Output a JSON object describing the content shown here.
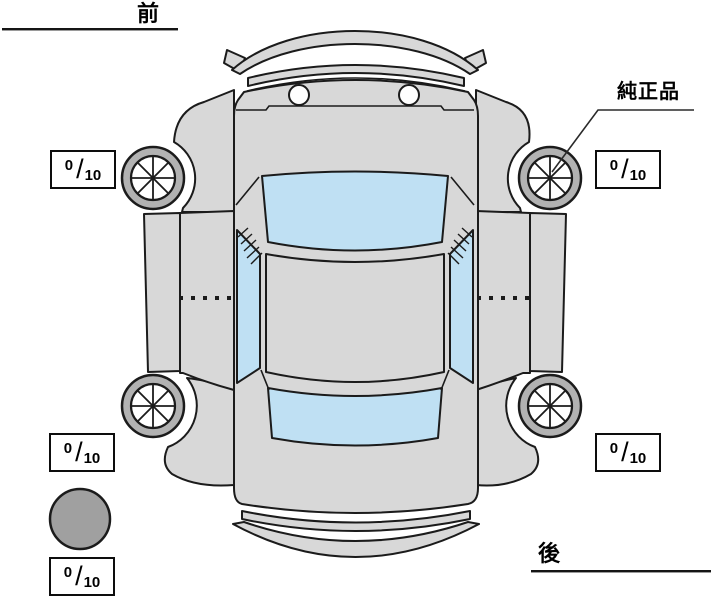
{
  "labels": {
    "front": "前",
    "rear": "後"
  },
  "annotation": {
    "genuine_part": "純正品"
  },
  "tread": {
    "front_left": {
      "value": "0",
      "separator": "/",
      "max": "10"
    },
    "front_right": {
      "value": "0",
      "separator": "/",
      "max": "10"
    },
    "rear_left": {
      "value": "0",
      "separator": "/",
      "max": "10"
    },
    "rear_right": {
      "value": "0",
      "separator": "/",
      "max": "10"
    },
    "spare": {
      "value": "0",
      "separator": "/",
      "max": "10"
    }
  },
  "icons": {
    "tire": "spoked-wheel-icon",
    "spare_tire": "filled-circle-icon"
  },
  "colors": {
    "body": "#d8d8d8",
    "glass": "#bfe0f3",
    "outline": "#1b1b1b",
    "tire_ring": "#b2b2b2",
    "spare_fill": "#a0a0a0"
  }
}
